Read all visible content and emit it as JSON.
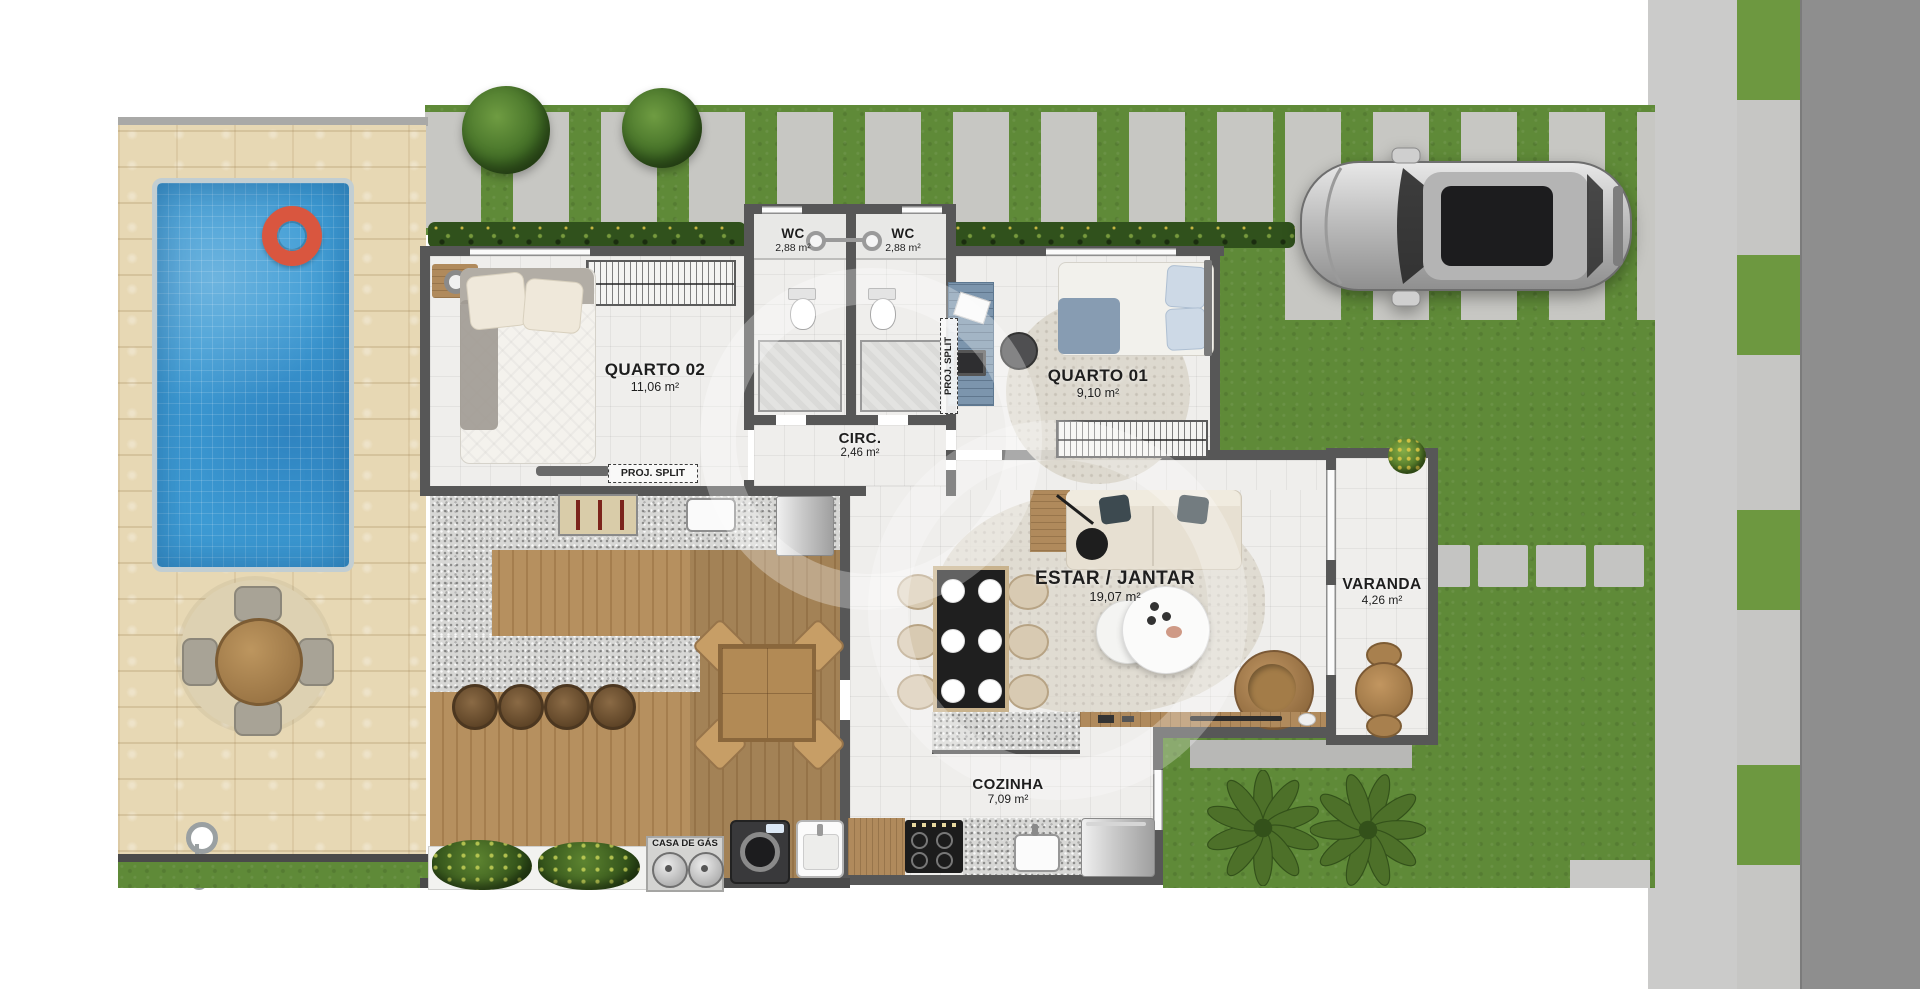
{
  "rooms": {
    "quarto02": {
      "name": "QUARTO 02",
      "area": "11,06 m²"
    },
    "wc1": {
      "name": "WC",
      "area": "2,88 m²"
    },
    "wc2": {
      "name": "WC",
      "area": "2,88 m²"
    },
    "quarto01": {
      "name": "QUARTO 01",
      "area": "9,10 m²"
    },
    "circ": {
      "name": "CIRC.",
      "area": "2,46 m²"
    },
    "estar_jantar": {
      "name": "ESTAR / JANTAR",
      "area": "19,07 m²"
    },
    "varanda": {
      "name": "VARANDA",
      "area": "4,26 m²"
    },
    "cozinha": {
      "name": "COZINHA",
      "area": "7,09 m²"
    }
  },
  "annotations": {
    "proj_split_quarto02": "PROJ. SPLIT",
    "proj_split_quarto01": "PROJ. SPLIT",
    "casa_de_gas": "CASA DE GÁS"
  },
  "colors": {
    "pool": "#3d9bd4",
    "grass": "#5f8a38",
    "deck_wood": "#b6905f",
    "patio_stone": "#e7d8b4",
    "road": "#8e8e8e",
    "sidewalk": "#cbcbca",
    "wall": "#575757",
    "swim_ring": "#d9563f",
    "hedge": "#30511c"
  }
}
